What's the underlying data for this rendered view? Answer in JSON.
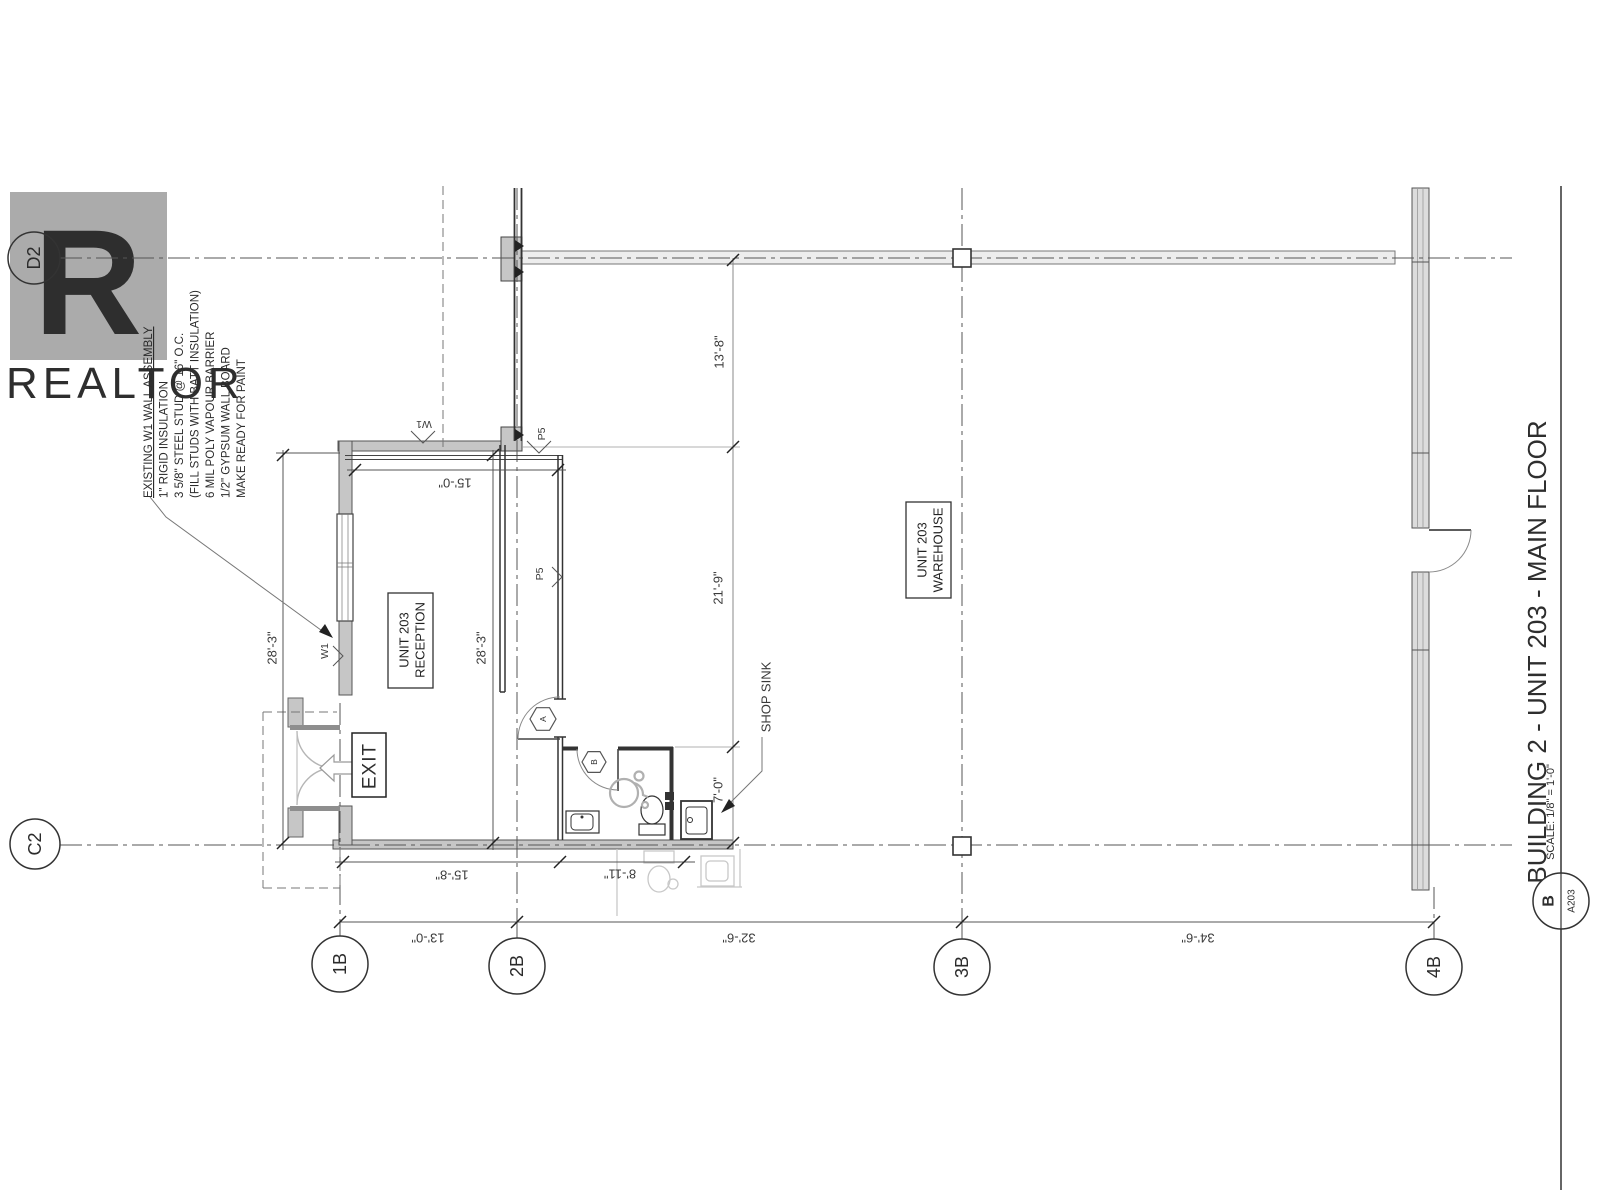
{
  "watermark": {
    "logo_letter": "R",
    "brand": "REALTOR"
  },
  "grid": {
    "d2": "D2",
    "c2": "C2",
    "b1": "1B",
    "b2": "2B",
    "b3": "3B",
    "b4": "4B"
  },
  "wall_note": {
    "title": "EXISTING W1 WALL ASSEMBLY",
    "line2": "1\" RIGID INSULATION",
    "line3": "3 5/8\" STEEL STUD @ 16\" O.C.",
    "line4": "(FILL STUDS WITH BATT INSULATION)",
    "line5": "6 MIL POLY VAPOUR BARRIER",
    "line6": "1/2\" GYPSUM WALL BOARD",
    "line7": "MAKE READY FOR PAINT"
  },
  "rooms": {
    "reception_line1": "UNIT 203",
    "reception_line2": "RECEPTION",
    "warehouse_line1": "UNIT 203",
    "warehouse_line2": "WAREHOUSE"
  },
  "labels": {
    "exit": "EXIT",
    "shop_sink": "SHOP SINK",
    "wall_tag_w1": "W1",
    "wall_tag_p5": "P5",
    "door_tag_a": "A",
    "door_tag_b": "B"
  },
  "dimensions": {
    "reception_width": "15'-0\"",
    "reception_height_left": "28'-3\"",
    "reception_height_mid": "28'-3\"",
    "north_bay": "13'-8\"",
    "mid_bay": "21'-9\"",
    "south_bay": "7'-0\"",
    "bottom_left": "15'-8\"",
    "bottom_mid": "8'-11\"",
    "grid_1b_2b": "13'-0\"",
    "grid_2b_3b": "32'-6\"",
    "grid_3b_4b": "34'-6\""
  },
  "title_block": {
    "title": "BUILDING 2 - UNIT 203 - MAIN FLOOR",
    "scale": "SCALE: 1/8\" = 1'-0\"",
    "detail_letter": "B",
    "sheet_number": "A203"
  }
}
